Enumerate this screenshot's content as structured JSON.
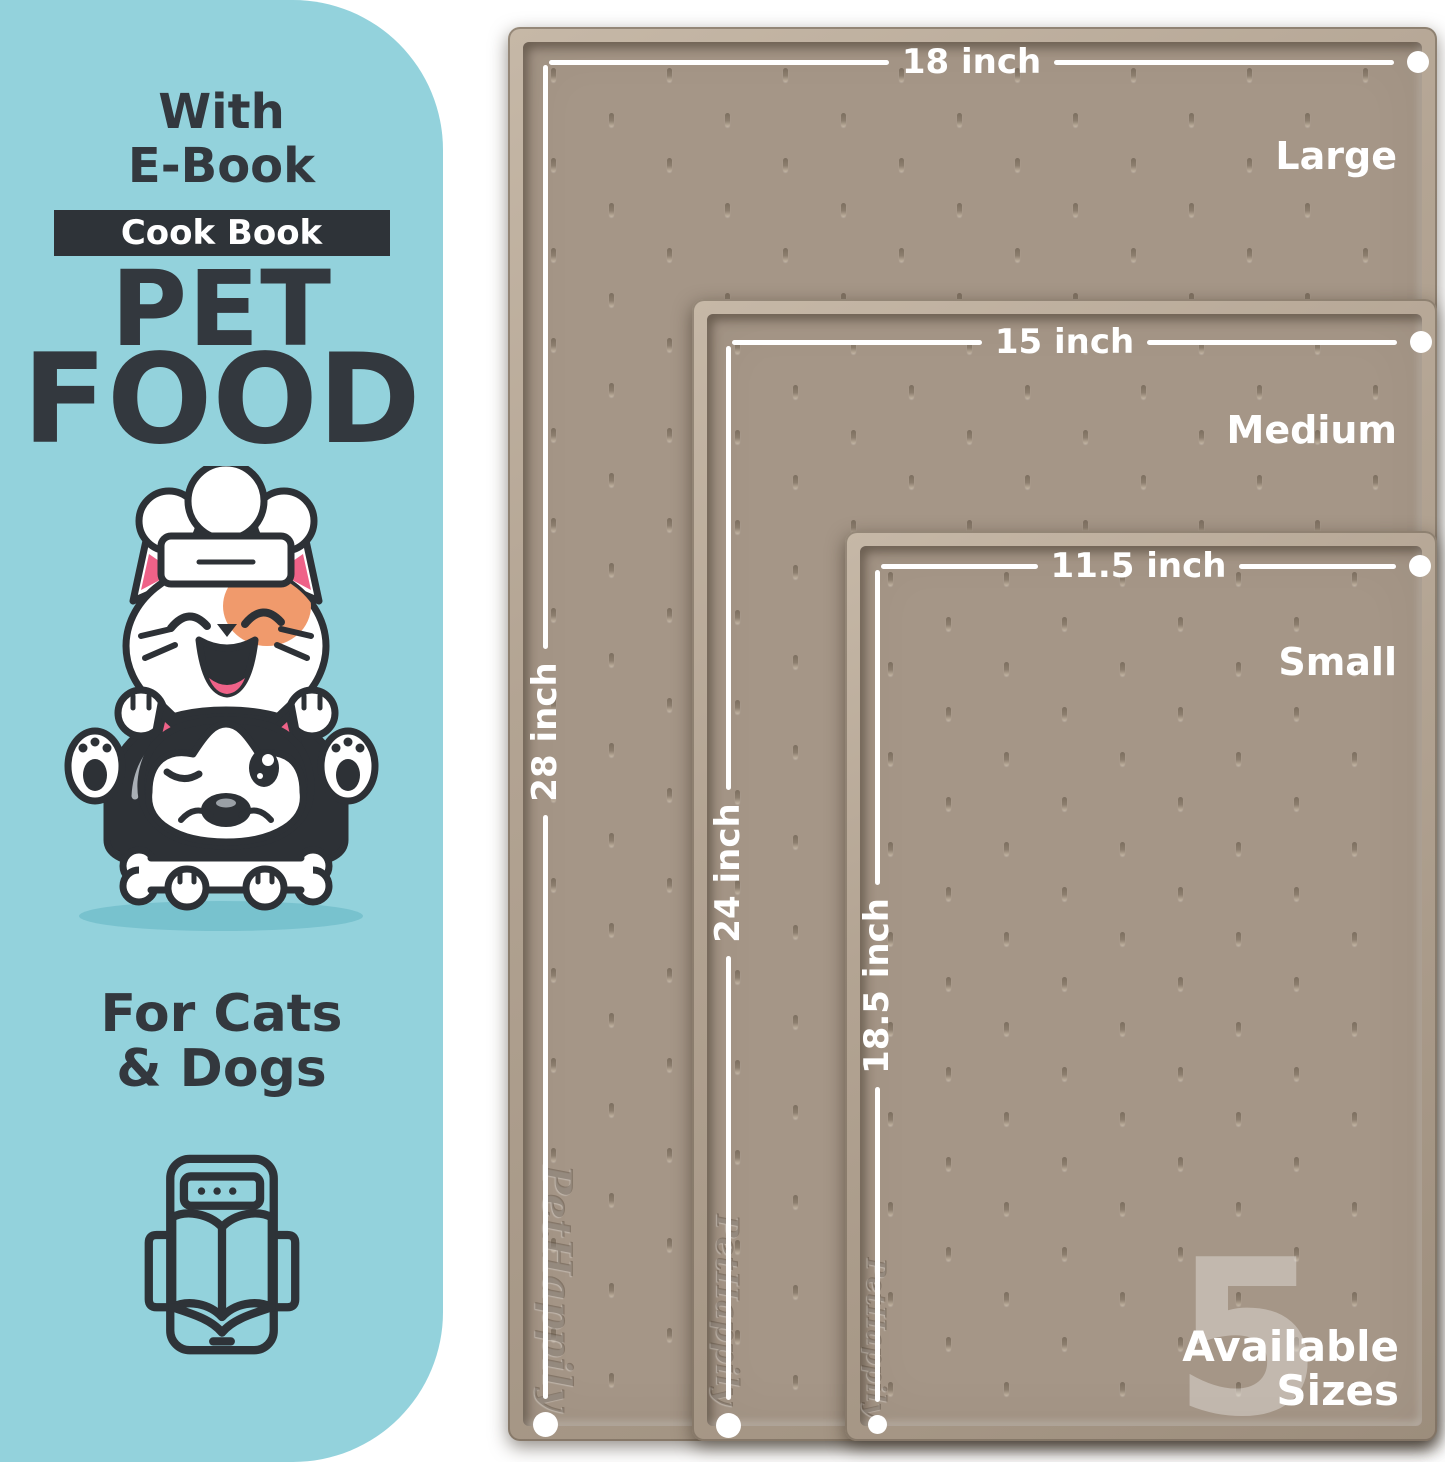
{
  "panel": {
    "heading_line1": "With",
    "heading_line2": "E-Book",
    "badge_label": "Cook Book",
    "title_line1": "PET",
    "title_line2": "FOOD",
    "audience_line1": "For Cats",
    "audience_line2": "& Dogs"
  },
  "mats": [
    {
      "size_name": "Large",
      "width_label": "18 inch",
      "height_label": "28 inch",
      "brand_embossed": "PetHappily"
    },
    {
      "size_name": "Medium",
      "width_label": "15 inch",
      "height_label": "24 inch",
      "brand_embossed": "PetHappily"
    },
    {
      "size_name": "Small",
      "width_label": "11.5 inch",
      "height_label": "18.5 inch",
      "brand_embossed": "PetHappily"
    }
  ],
  "sizes_badge": {
    "count": "5",
    "line1": "Available",
    "line2": "Sizes"
  },
  "colors": {
    "panel_teal": "#93d2dc",
    "ink": "#33383e",
    "mat_surface": "#a59687",
    "mat_rim": "#b3a493",
    "accent_pink": "#ef6288",
    "accent_orange": "#f09a6c",
    "silver": "#a9afb5",
    "white": "#ffffff"
  },
  "icons": {
    "illustration": "cat-dog-chef-illustration",
    "ebook": "ebook-tablet-icon"
  }
}
